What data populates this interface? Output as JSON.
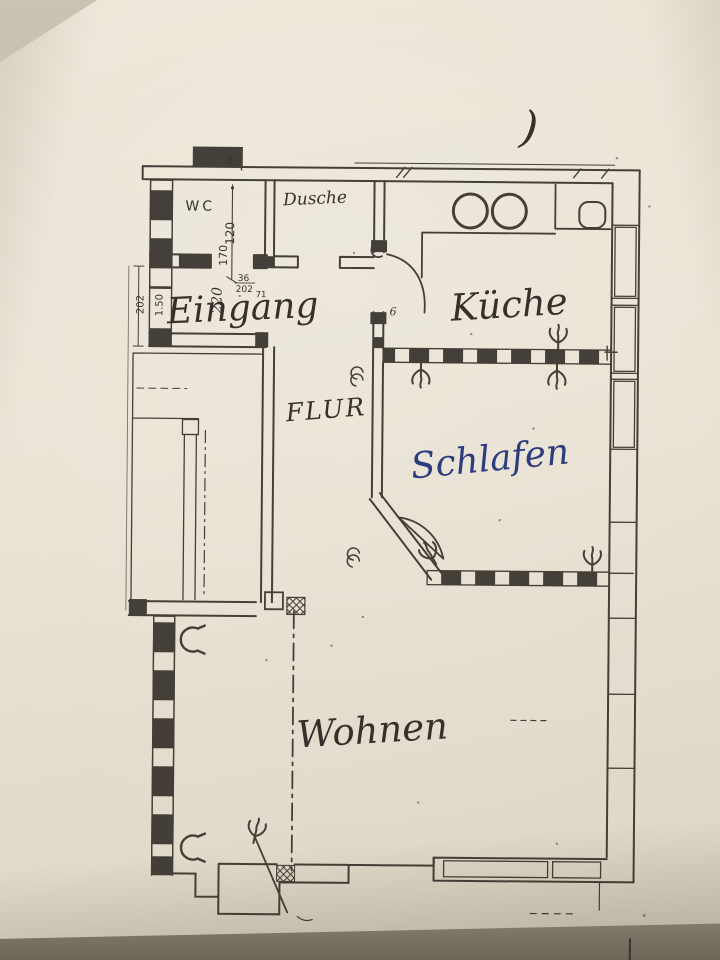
{
  "rooms": {
    "wc": "WC",
    "dusche": "Dusche",
    "eingang": "Eingang",
    "kueche": "Küche",
    "flur": "FLUR",
    "schlafen": "Schlafen",
    "wohnen": "Wohnen"
  },
  "dimensions": {
    "d120": "120",
    "d170": "170",
    "d36": "36",
    "d202a": "202",
    "d71": "71",
    "d220": "220",
    "d202b": "202",
    "d150": "1.50",
    "d2": "2",
    "d6": "6"
  },
  "pen_marks": {
    "paren": ")"
  },
  "colors": {
    "ink": "#35302a",
    "blue_ink": "#2e3c7e",
    "paper": "#e8e1d3",
    "surface": "#b9b1a0"
  },
  "icons": {
    "radiator-icon": "crow-foot-glyph",
    "radiator-c-icon": "c-bracket-glyph",
    "hob-rings-icon": "two-circles",
    "sink-icon": "rounded-square",
    "shaft-icon": "cross-hatched-square",
    "chimney-icon": "filled-black-square"
  }
}
